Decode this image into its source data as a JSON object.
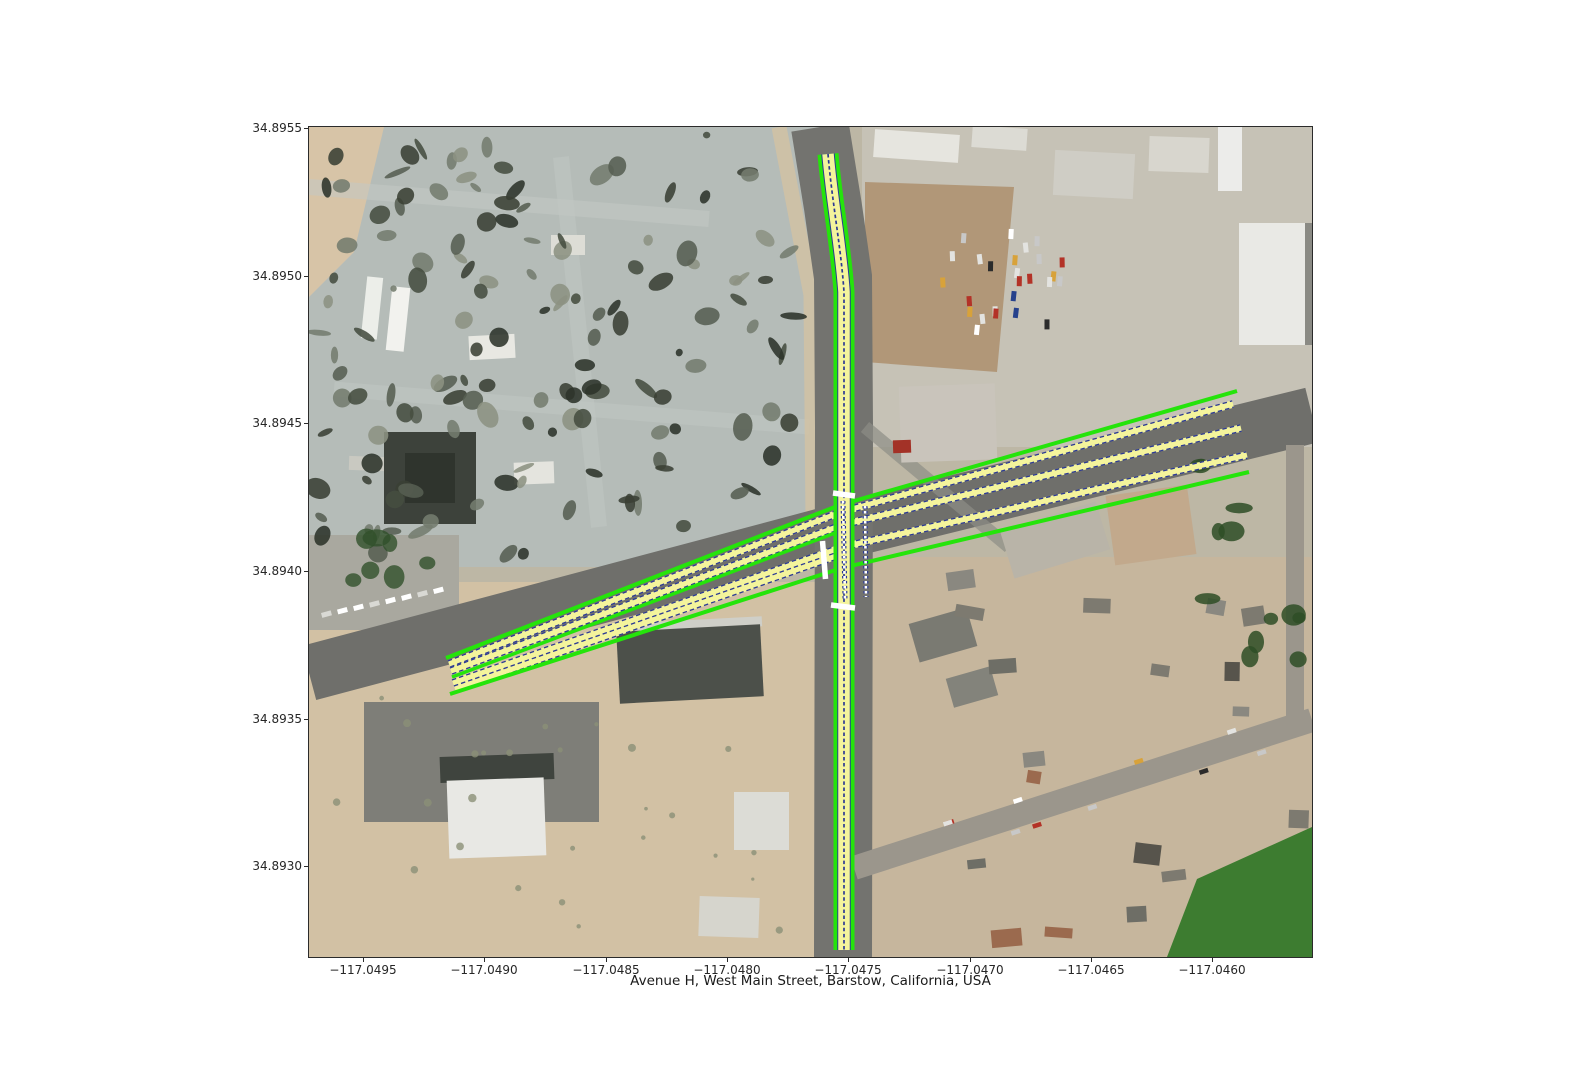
{
  "figure": {
    "xlabel": "Avenue H, West Main Street, Barstow, California, USA"
  },
  "axes": {
    "y_ticks": [
      "34.8955",
      "34.8950",
      "34.8945",
      "34.8940",
      "34.8935",
      "34.8930"
    ],
    "x_ticks": [
      "−117.0495",
      "−117.0490",
      "−117.0485",
      "−117.0480",
      "−117.0475",
      "−117.0470",
      "−117.0465",
      "−117.0460"
    ]
  },
  "map": {
    "location": "Avenue H, West Main Street, Barstow, California, USA",
    "roads": [
      "Avenue H",
      "West Main Street"
    ],
    "imagery": "satellite",
    "annotation_colors": {
      "lane_edge_green": "#25e40b",
      "lane_fill_yellow": "#f4f49c",
      "lane_divider_blue": "#2c3a94",
      "stop_bar_white": "#ffffff"
    }
  }
}
